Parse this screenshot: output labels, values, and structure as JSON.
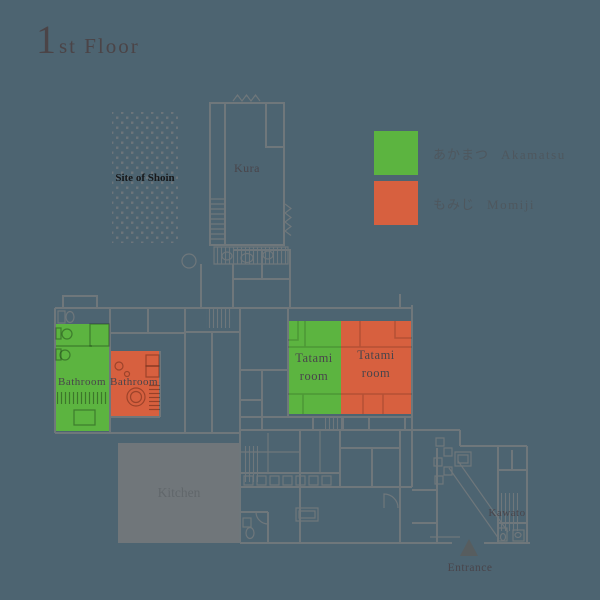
{
  "title": {
    "numeral": "1",
    "rest": "st Floor"
  },
  "legend": {
    "items": [
      {
        "ja": "あかまつ",
        "en": "Akamatsu",
        "color": "#5cb440"
      },
      {
        "ja": "もみじ",
        "en": "Momiji",
        "color": "#d7603f"
      }
    ]
  },
  "rooms": {
    "shoin": {
      "label": "Site of Shoin"
    },
    "kura": {
      "label": "Kura"
    },
    "bathroom_akamatsu": {
      "label": "Bathroom"
    },
    "bathroom_momiji": {
      "label": "Bathroom"
    },
    "tatami_akamatsu": {
      "line1": "Tatami",
      "line2": "room"
    },
    "tatami_momiji": {
      "line1": "Tatami",
      "line2": "room"
    },
    "kitchen": {
      "label": "Kitchen"
    },
    "kawato": {
      "label": "Kawato"
    },
    "entrance": {
      "label": "Entrance"
    }
  },
  "colors": {
    "background": "#4d6471",
    "wall": "#6f777b",
    "kitchen_fill": "#70767a",
    "akamatsu": "#5cb440",
    "momiji": "#d7603f"
  }
}
